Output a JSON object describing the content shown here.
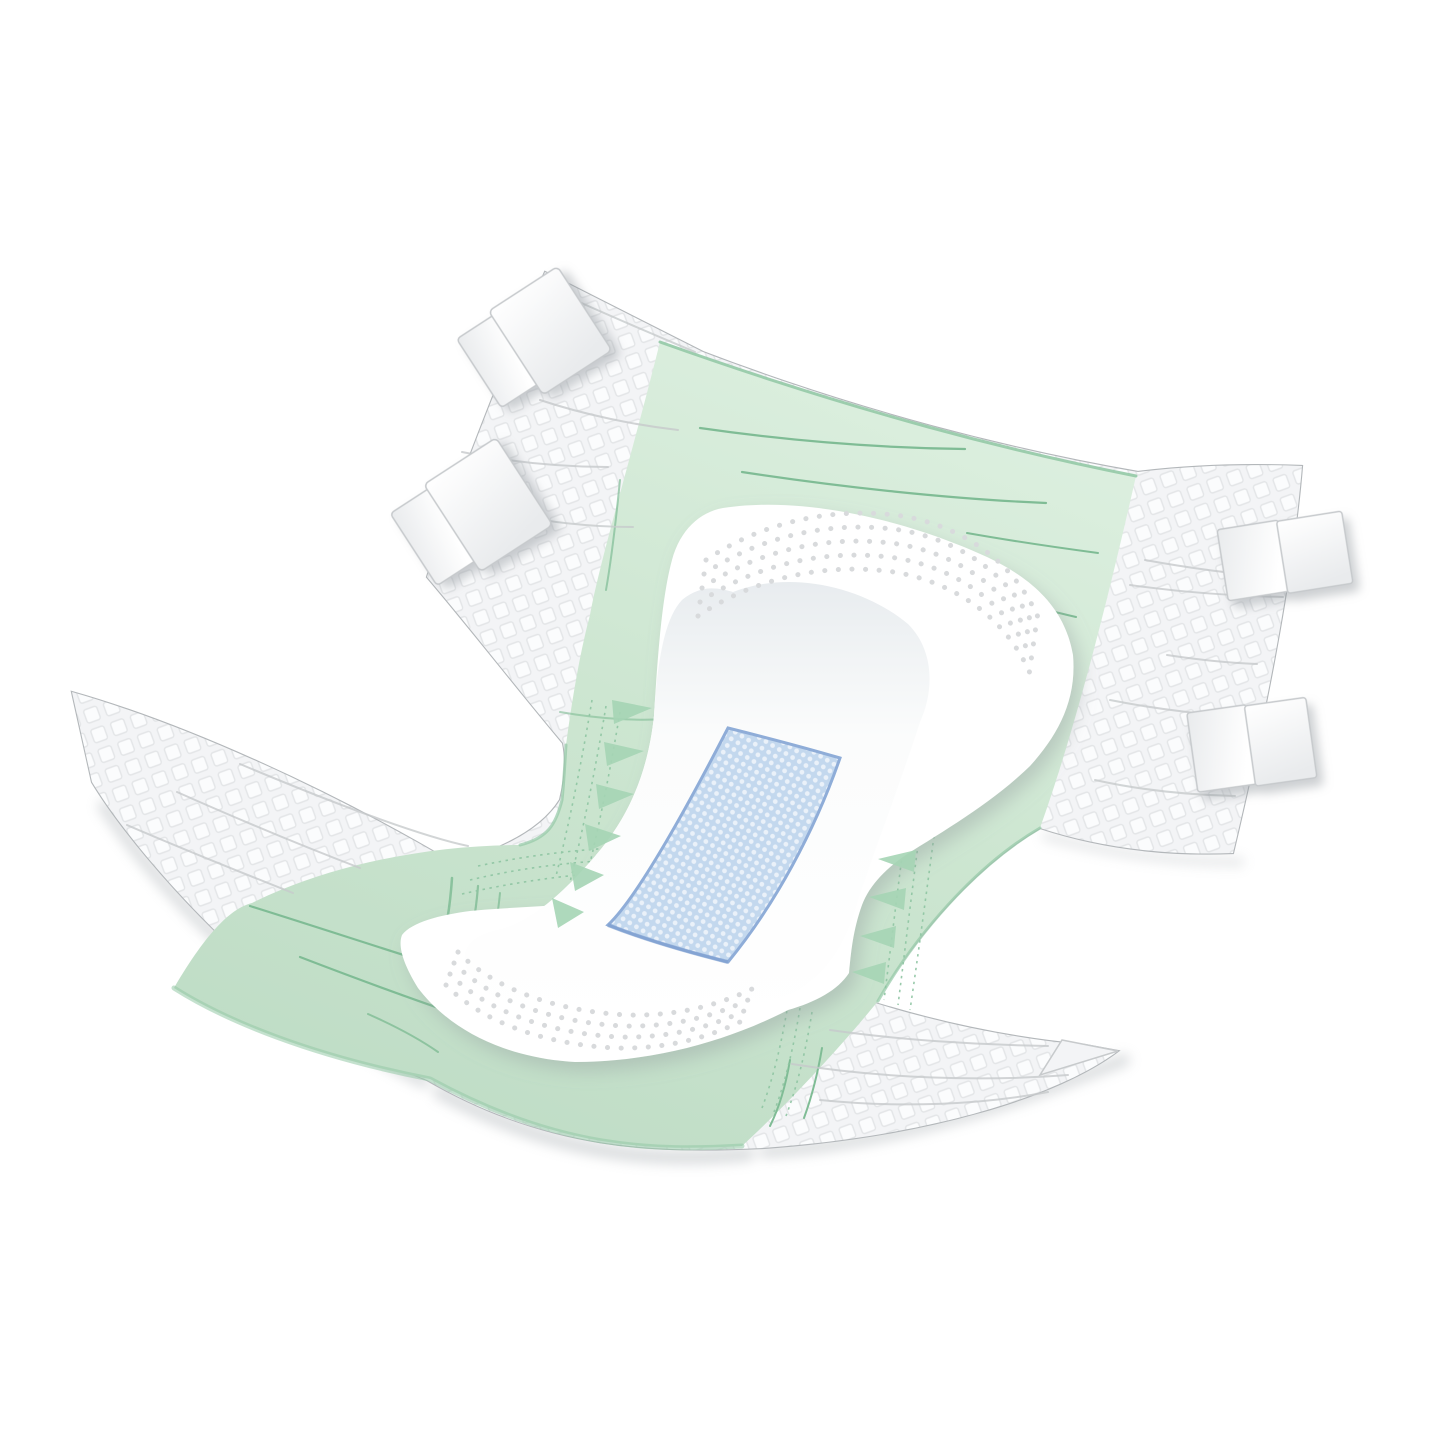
{
  "illustration": {
    "subject": "disposable adult incontinence brief, opened flat, angled product view on white background",
    "parts": {
      "chassis": "white nonwoven side panels with quilted diamond texture",
      "backsheet": "light green breathable backsheet film",
      "absorbent_pad": "white hourglass absorbent core",
      "acquisition_layer": "blue quilted acquisition patch",
      "closure_tapes": "four white fold-over closure tapes",
      "leg_gathers": "green zigzag elastic leg gathers",
      "embossing": "embossed dot arcs on pad"
    },
    "colors": {
      "background": "#ffffff",
      "sheet_fill": "#fcfdfd",
      "sheet_edge": "#b3b7ba",
      "texture_base": "#f3f4f6",
      "texture_tile": "#fbfcfd",
      "texture_line": "#e3e5e7",
      "green_light": "#dcefdf",
      "green_mid": "#cde6d1",
      "green_deep": "#bedcc5",
      "green_edge": "#94c9a6",
      "green_line": "#7fbc95",
      "green_stitch": "#8ec5a2",
      "green_zigzag": "#a6d5b5",
      "crease": "#c7cacc",
      "pad_fill": "#ffffff",
      "pad_inner_top": "#e8ecef",
      "pad_inner_low": "#fbfcfc",
      "pad_dot": "#d8dadc",
      "blue_fill": "#c3d8ee",
      "blue_dot": "#eaf1f9",
      "blue_border": "#8fadd8",
      "blue_edge": "#7d9fd0",
      "tab_face": "#ffffff",
      "tab_shade": "#e9ebed",
      "tab_edge": "#c6c9cc",
      "ground_shadow": "#aeb4b8",
      "soft_shadow": "#8f969b"
    }
  }
}
